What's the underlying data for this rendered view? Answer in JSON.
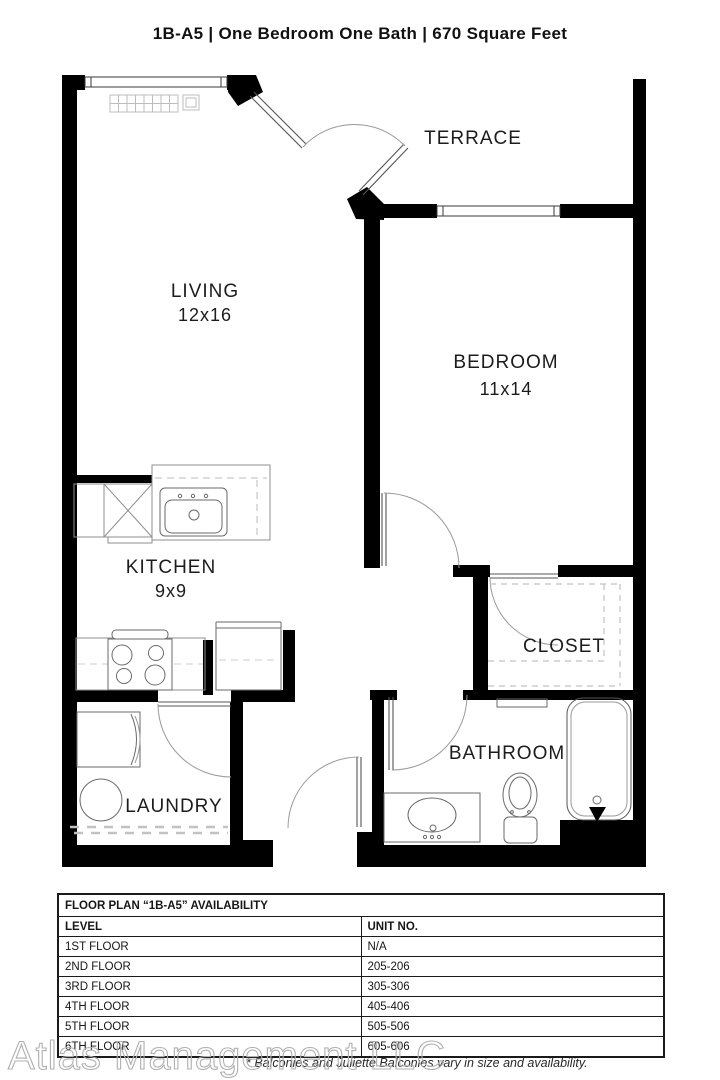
{
  "header": {
    "title": "1B-A5  |  One Bedroom One Bath  |  670 Square Feet"
  },
  "floor_plan": {
    "rooms": {
      "terrace": {
        "label": "TERRACE"
      },
      "living": {
        "label": "LIVING",
        "dims": "12x16"
      },
      "bedroom": {
        "label": "BEDROOM",
        "dims": "11x14"
      },
      "kitchen": {
        "label": "KITCHEN",
        "dims": "9x9"
      },
      "closet": {
        "label": "CLOSET"
      },
      "laundry": {
        "label": "LAUNDRY"
      },
      "bathroom": {
        "label": "BATHROOM"
      }
    }
  },
  "availability_table": {
    "title": "FLOOR PLAN “1B-A5” AVAILABILITY",
    "columns": [
      "LEVEL",
      "UNIT NO."
    ],
    "rows": [
      [
        "1ST FLOOR",
        "N/A"
      ],
      [
        "2ND FLOOR",
        "205-206"
      ],
      [
        "3RD FLOOR",
        "305-306"
      ],
      [
        "4TH FLOOR",
        "405-406"
      ],
      [
        "5TH FLOOR",
        "505-506"
      ],
      [
        "6TH FLOOR",
        "605-606"
      ]
    ]
  },
  "footer": {
    "watermark": "Atlas Management LLC",
    "disclaimer": "* Balconies and Juliette Balconies vary in size and availability."
  },
  "colors": {
    "wall": "#000000",
    "fixture_line": "#666666",
    "dash_line": "#bbbbbb",
    "text": "#1c1c1c",
    "watermark_stroke": "#b0b0b0"
  }
}
